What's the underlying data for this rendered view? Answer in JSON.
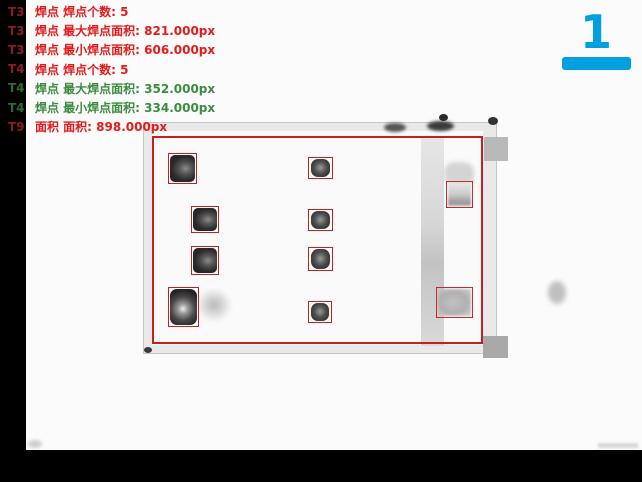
{
  "window": {
    "width": 642,
    "height": 482
  },
  "annotations": {
    "lines": [
      {
        "tag": "T3",
        "text": "焊点 焊点个数: 5",
        "color": "red"
      },
      {
        "tag": "T3",
        "text": "焊点 最大焊点面积: 821.000px",
        "color": "red"
      },
      {
        "tag": "T3",
        "text": "焊点 最小焊点面积: 606.000px",
        "color": "red"
      },
      {
        "tag": "T4",
        "text": "焊点 焊点个数: 5",
        "color": "red"
      },
      {
        "tag": "T4",
        "text": "焊点 最大焊点面积: 352.000px",
        "color": "green"
      },
      {
        "tag": "T4",
        "text": "焊点 最小焊点面积: 334.000px",
        "color": "green"
      },
      {
        "tag": "T9",
        "text": "面积 面积: 898.000px",
        "color": "red"
      }
    ]
  },
  "step_indicator": {
    "label": "1"
  },
  "colors": {
    "annotation_red": "#e31b1b",
    "annotation_green": "#3d8b40",
    "tag_red": "#8f1b1b",
    "tag_green": "#2e6b2e",
    "detection_box_red": "#c42020",
    "step_cyan": "#00a0e0"
  },
  "detections": {
    "region_box": {
      "x": 152,
      "y": 136,
      "w": 331,
      "h": 208
    },
    "boxes": [
      {
        "x": 168,
        "y": 153,
        "w": 29,
        "h": 31,
        "kind": "pad-dark"
      },
      {
        "x": 191,
        "y": 206,
        "w": 28,
        "h": 27,
        "kind": "pad-dark"
      },
      {
        "x": 191,
        "y": 246,
        "w": 28,
        "h": 29,
        "kind": "pad-dark"
      },
      {
        "x": 168,
        "y": 287,
        "w": 31,
        "h": 40,
        "kind": "pad-dark-highlight"
      },
      {
        "x": 308,
        "y": 157,
        "w": 25,
        "h": 22,
        "kind": "pin-dark"
      },
      {
        "x": 308,
        "y": 209,
        "w": 25,
        "h": 22,
        "kind": "pin-dark"
      },
      {
        "x": 308,
        "y": 247,
        "w": 25,
        "h": 24,
        "kind": "pin-dark"
      },
      {
        "x": 308,
        "y": 301,
        "w": 24,
        "h": 22,
        "kind": "pin-dark"
      },
      {
        "x": 446,
        "y": 181,
        "w": 27,
        "h": 27,
        "kind": "faint-top"
      },
      {
        "x": 436,
        "y": 287,
        "w": 37,
        "h": 31,
        "kind": "faint-bottom"
      }
    ]
  }
}
